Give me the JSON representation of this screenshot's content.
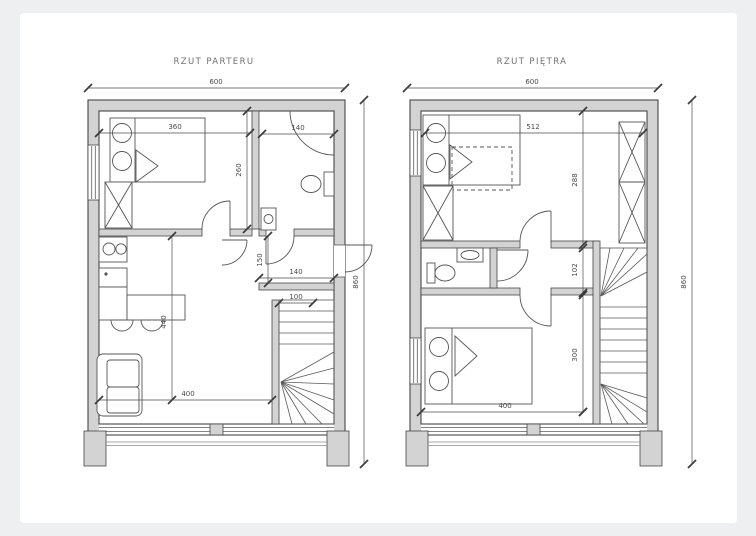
{
  "page": {
    "background": "#edeff1",
    "card_background": "#ffffff"
  },
  "colors": {
    "wall_fill": "#d3d3d3",
    "line": "#464646",
    "dimension": "#4a4a4a"
  },
  "plans": {
    "ground": {
      "title": "RZUT PARTERU",
      "dims": {
        "width_total": "600",
        "height_total": "860",
        "bedroom_width": "360",
        "bath_width": "140",
        "bedroom_depth": "260",
        "hall_depth": "150",
        "hall_width": "140",
        "stairs_entry": "100",
        "living_depth": "440",
        "living_width": "400"
      }
    },
    "upper": {
      "title": "RZUT PIĘTRA",
      "dims": {
        "width_total": "600",
        "height_total": "860",
        "bedroom_width": "512",
        "bedroom_depth": "288",
        "corridor_depth": "102",
        "bedroom2_depth": "300",
        "bedroom2_width": "400"
      }
    }
  }
}
